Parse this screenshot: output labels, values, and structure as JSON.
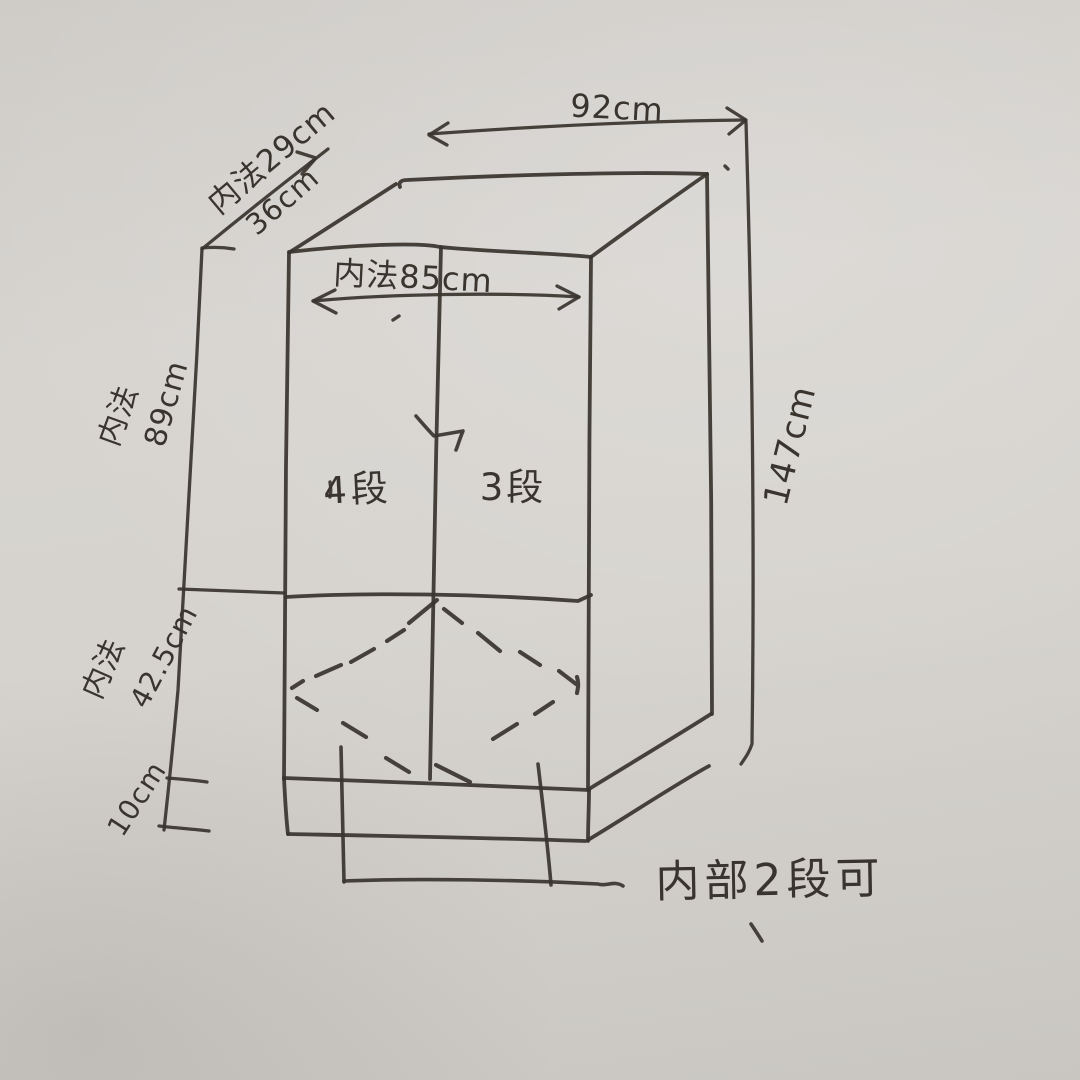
{
  "sketch": {
    "paper_color": "#d4d1cc",
    "ink_color": "#3a352e",
    "dimensions": {
      "outer_width": "92cm",
      "outer_height": "147cm",
      "inner_depth": "内法29cm",
      "outer_depth": "36cm",
      "inner_width": "内法85cm",
      "upper_section_prefix": "内法",
      "upper_section_height": "89cm",
      "lower_section_prefix": "内法",
      "lower_section_height": "42.5cm",
      "base_height": "10cm"
    },
    "annotations": {
      "left_column": "4段",
      "right_column": "3段",
      "bottom_note": "内部2段可"
    }
  }
}
